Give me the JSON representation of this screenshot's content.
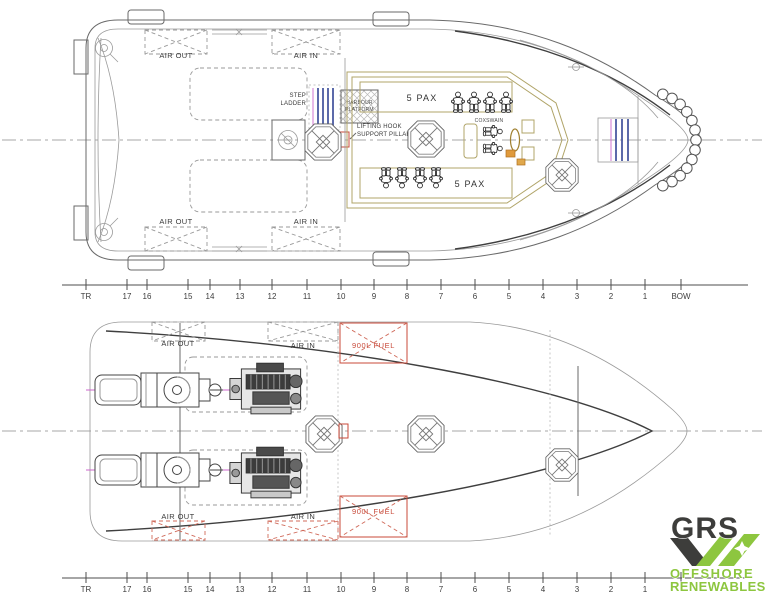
{
  "top_view": {
    "air_out": "AIR OUT",
    "air_in": "AIR IN",
    "step_ladder_1": "STEP",
    "step_ladder_2": "LADDER",
    "harbour_platform_1": "HARBOUR",
    "harbour_platform_2": "PLATFORM",
    "lifting_hook_1": "LIFTING HOOK",
    "lifting_hook_2": "SUPPORT PILLAR",
    "pax_upper": "5 PAX",
    "pax_lower": "5 PAX",
    "coxswain": "COXSWAIN"
  },
  "bottom_view": {
    "air_out": "AIR OUT",
    "air_in": "AIR IN",
    "fuel_upper": "900L FUEL",
    "fuel_lower": "900L FUEL"
  },
  "rulers": {
    "top": {
      "stations": [
        {
          "label": "TR",
          "x": 86
        },
        {
          "label": "17",
          "x": 127
        },
        {
          "label": "16",
          "x": 147
        },
        {
          "label": "15",
          "x": 188
        },
        {
          "label": "14",
          "x": 210
        },
        {
          "label": "13",
          "x": 240
        },
        {
          "label": "12",
          "x": 272
        },
        {
          "label": "11",
          "x": 307
        },
        {
          "label": "10",
          "x": 341
        },
        {
          "label": "9",
          "x": 374
        },
        {
          "label": "8",
          "x": 407
        },
        {
          "label": "7",
          "x": 441
        },
        {
          "label": "6",
          "x": 475
        },
        {
          "label": "5",
          "x": 509
        },
        {
          "label": "4",
          "x": 543
        },
        {
          "label": "3",
          "x": 577
        },
        {
          "label": "2",
          "x": 611
        },
        {
          "label": "1",
          "x": 645
        },
        {
          "label": "BOW",
          "x": 681
        }
      ]
    },
    "bottom": {
      "stations": [
        {
          "label": "TR",
          "x": 86
        },
        {
          "label": "17",
          "x": 127
        },
        {
          "label": "16",
          "x": 147
        },
        {
          "label": "15",
          "x": 188
        },
        {
          "label": "14",
          "x": 210
        },
        {
          "label": "13",
          "x": 240
        },
        {
          "label": "12",
          "x": 272
        },
        {
          "label": "11",
          "x": 307
        },
        {
          "label": "10",
          "x": 341
        },
        {
          "label": "9",
          "x": 374
        },
        {
          "label": "8",
          "x": 407
        },
        {
          "label": "7",
          "x": 441
        },
        {
          "label": "6",
          "x": 475
        },
        {
          "label": "5",
          "x": 509
        },
        {
          "label": "4",
          "x": 543
        },
        {
          "label": "3",
          "x": 577
        },
        {
          "label": "2",
          "x": 611
        },
        {
          "label": "1",
          "x": 645
        },
        {
          "label": "",
          "x": 681
        }
      ]
    }
  },
  "logo": {
    "grs": "GRS",
    "offshore": "OFFSHORE",
    "renewables": "RENEWABLES",
    "green": "#8dc63f",
    "dark": "#3d3d3b"
  },
  "colors": {
    "line_dark": "#3f3f3f",
    "line_light": "#9a9a9a",
    "tan": "#b0a468",
    "red": "#c84a3a",
    "magenta": "#cc66cc",
    "blue": "#4a5aa0"
  }
}
